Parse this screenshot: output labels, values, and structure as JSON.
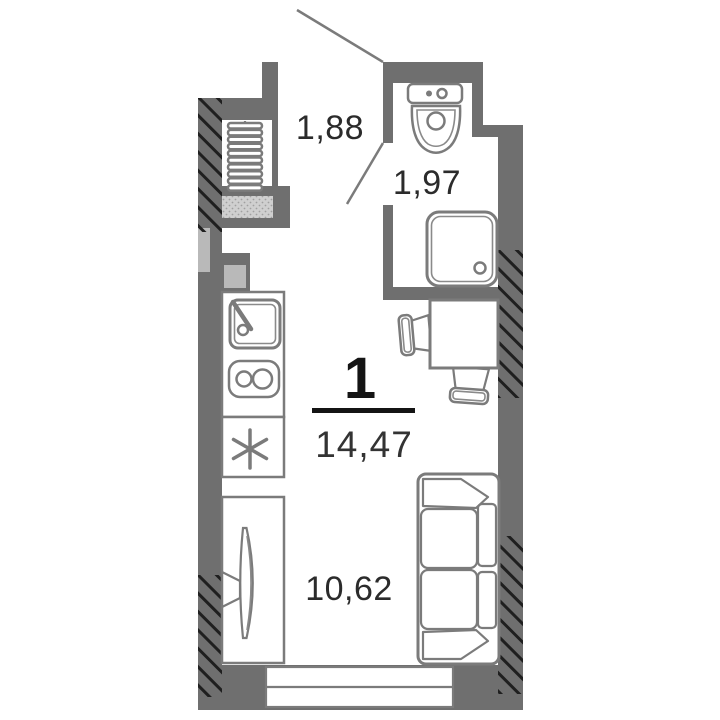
{
  "floor_plan": {
    "rooms_count_label": "1",
    "total_area_label": "14,47",
    "area_labels": {
      "hall": "1,88",
      "bathroom": "1,97",
      "living": "10,62"
    },
    "icons": {
      "entry-door-swing-icon": "diagonal-line",
      "bathroom-door-swing-icon": "diagonal-line",
      "wardrobe-hangers-icon": "stacked-bars",
      "ventilation-duct-icon": "gray-square",
      "kitchen-sink-icon": "square-basin-with-faucet",
      "stove-icon": "two-burners",
      "fridge-asterisk-icon": "six-spoke-star",
      "tv-icon": "curved-screen-on-wall-mount",
      "toilet-icon": "tank-and-bowl",
      "shower-icon": "tray-with-drain",
      "dining-table-icon": "square",
      "chair-icon": "back-and-seat",
      "sofa-icon": "two-seats-armrests",
      "window-icon": "double-pane-strip"
    },
    "colors": {
      "wall": "#6f6f6f",
      "furniture_stroke": "#7b7b7b",
      "hatch": "#1f1f1f",
      "label_text": "#2b2b2b",
      "headline_text": "#141414",
      "light_panel": "#b9b9b9",
      "stipple_panel": "#cfcfcf",
      "background": "#ffffff"
    }
  }
}
